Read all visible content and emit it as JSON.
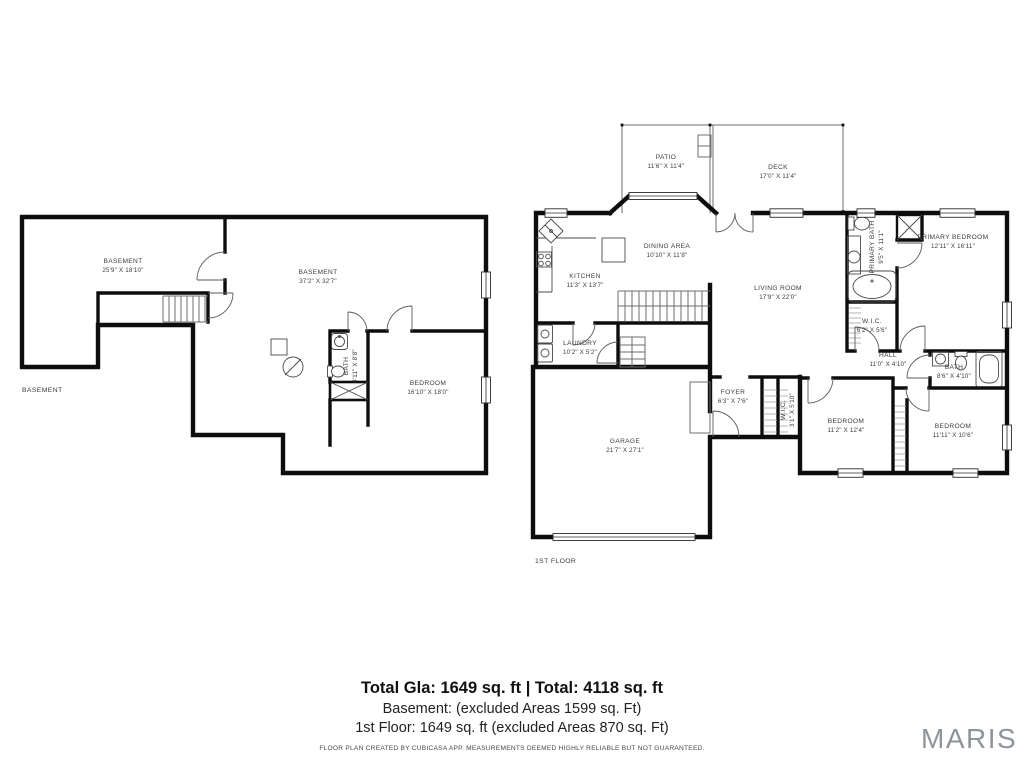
{
  "basement_plan": {
    "floor_label": "BASEMENT",
    "rooms": [
      {
        "name": "BASEMENT",
        "dims": "25'9\" X 18'10\""
      },
      {
        "name": "BASEMENT",
        "dims": "37'2\" X 32'7\""
      },
      {
        "name": "BATH",
        "dims": "4'11\" X 8'8\""
      },
      {
        "name": "BEDROOM",
        "dims": "16'10\" X 18'0\""
      }
    ]
  },
  "first_floor_plan": {
    "floor_label": "1ST FLOOR",
    "rooms": [
      {
        "name": "PATIO",
        "dims": "11'6\" X 11'4\""
      },
      {
        "name": "DECK",
        "dims": "17'0\" X 11'4\""
      },
      {
        "name": "DINING AREA",
        "dims": "10'10\" X 11'8\""
      },
      {
        "name": "KITCHEN",
        "dims": "11'3\" X 13'7\""
      },
      {
        "name": "LAUNDRY",
        "dims": "10'2\" X 5'2\""
      },
      {
        "name": "LIVING ROOM",
        "dims": "17'9\" X 22'0\""
      },
      {
        "name": "PRIMARY BATH",
        "dims": "9'5\" X 11'1\""
      },
      {
        "name": "PRIMARY BEDROOM",
        "dims": "12'11\" X 16'11\""
      },
      {
        "name": "W.I.C.",
        "dims": "6'2\" X 5'6\""
      },
      {
        "name": "HALL",
        "dims": "11'0\" X 4'10\""
      },
      {
        "name": "BATH",
        "dims": "8'6\" X 4'10\""
      },
      {
        "name": "FOYER",
        "dims": "6'3\" X 7'6\""
      },
      {
        "name": "W.I.C.",
        "dims": "3'1\" X 5'10\""
      },
      {
        "name": "BEDROOM",
        "dims": "11'2\" X 12'4\""
      },
      {
        "name": "BEDROOM",
        "dims": "11'11\" X 10'6\""
      },
      {
        "name": "GARAGE",
        "dims": "21'7\" X 27'1\""
      }
    ]
  },
  "summary": {
    "total_line": "Total Gla: 1649 sq. ft | Total: 4118 sq. ft",
    "basement_line": "Basement: (excluded Areas 1599 sq. Ft)",
    "first_floor_line": "1st Floor: 1649 sq. ft (excluded Areas 870 sq. Ft)",
    "disclaimer": "FLOOR PLAN CREATED BY CUBICASA APP. MEASUREMENTS DEEMED HIGHLY RELIABLE BUT NOT GUARANTEED."
  },
  "branding": {
    "logo_text": "MARIS"
  },
  "colors": {
    "wall": "#0d0d0d",
    "thin_line": "#6e6e6e",
    "label_text": "#3b3b3b",
    "logo_gray": "#8f939b"
  }
}
